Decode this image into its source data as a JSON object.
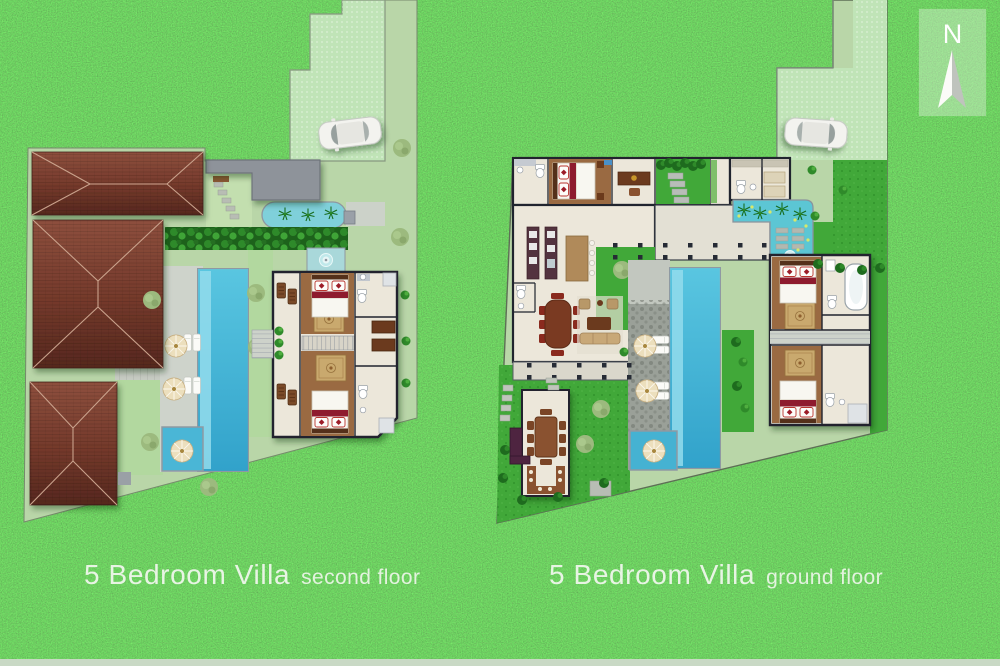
{
  "compass": {
    "letter": "N"
  },
  "plans": [
    {
      "id": "second-floor",
      "title": "5 Bedroom Villa",
      "subtitle": "second floor"
    },
    {
      "id": "ground-floor",
      "title": "5 Bedroom Villa",
      "subtitle": "ground floor"
    }
  ],
  "colors": {
    "grass": "#3a9c36",
    "plot_lawn": "#b9d6a8",
    "driveway": "#c0e4b7",
    "vivid_lawn": "#41a839",
    "roof_brown": "#74392b",
    "pool_blue": "#3fb4d8",
    "water_feature": "#5cc6d4",
    "accent_red": "#9c1d28",
    "wood_floor": "#9a6a42",
    "floor_cream": "#ece7da",
    "label_text": "#e8f4e4",
    "bottom_strip": "#c9d9c5"
  }
}
